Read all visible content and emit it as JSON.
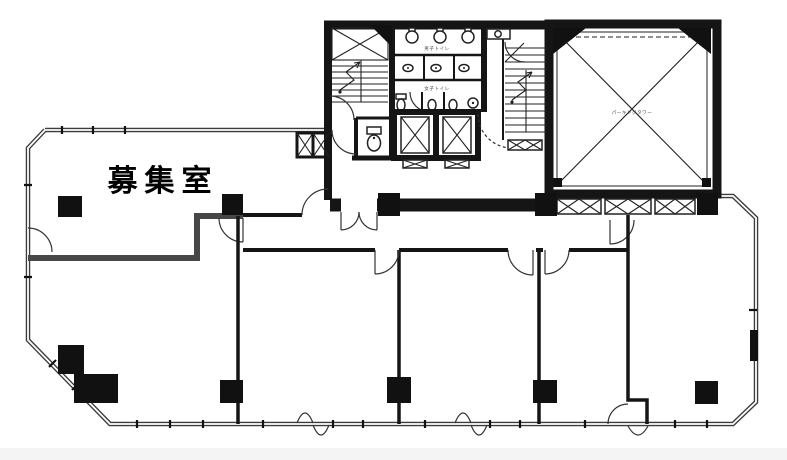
{
  "document": {
    "type": "building-floor-plan"
  },
  "colors": {
    "background": "#ffffff",
    "wall_black": "#151515",
    "wall_gray": "#474747",
    "perimeter_wall": "#3c3c3c"
  },
  "labels": {
    "main_room": "募集室",
    "mens_toilet": "男子トイレ",
    "womens_toilet": "女子トイレ",
    "shaft": "パーキングタワー"
  }
}
